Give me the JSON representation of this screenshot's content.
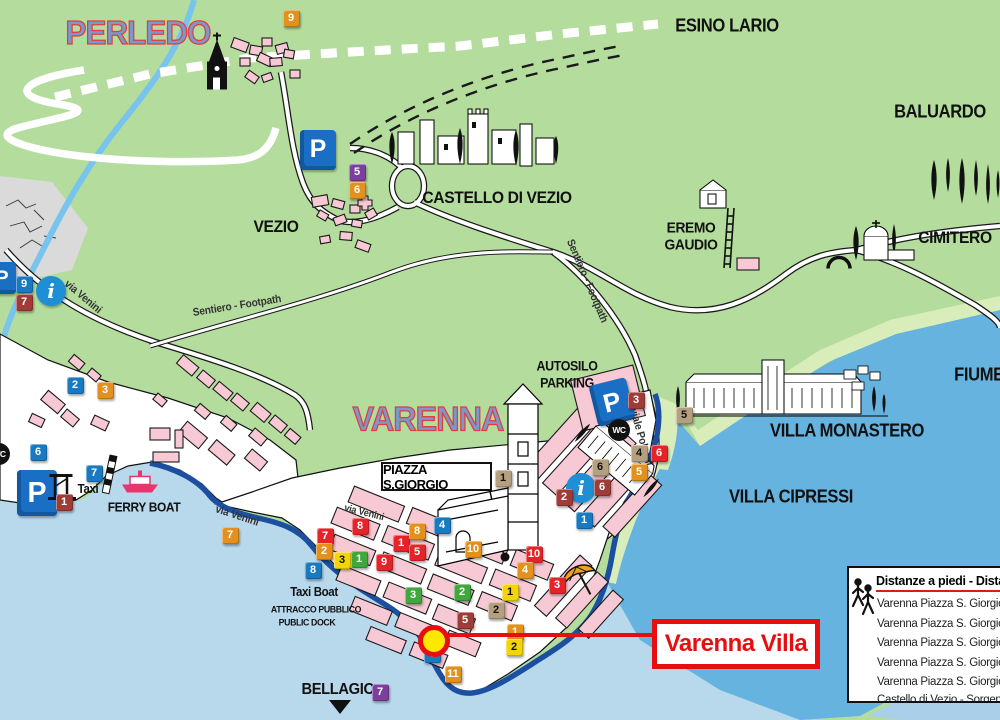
{
  "colors": {
    "land": "#b4dd9d",
    "land_light": "#d9edbb",
    "water_pale": "#b8d8ec",
    "water_deep": "#66b3e0",
    "water_corner": "#a9cfe9",
    "river": "#78c4ec",
    "building": "#f7c9d4",
    "promenade": "#1c4fa0",
    "title_fill": "#7b97cb",
    "title_stroke": "#e23d3d",
    "callout_red": "#e60f0f",
    "marker_blue": "#187ac1",
    "marker_red": "#e62329",
    "marker_orange": "#e3901d",
    "marker_yellow": "#f3d406",
    "marker_green": "#3fa73c",
    "marker_maroon": "#a03c38",
    "marker_tan": "#b49f7e",
    "marker_purple": "#7d3f9d"
  },
  "titles": [
    {
      "text": "PERLEDO",
      "x": 138,
      "y": 33,
      "size": 33
    },
    {
      "text": "VARENNA",
      "x": 428,
      "y": 420,
      "size": 34
    }
  ],
  "labels": [
    {
      "text": "ESINO LARIO",
      "x": 727,
      "y": 26,
      "size": 18
    },
    {
      "text": "BALUARDO",
      "x": 940,
      "y": 112,
      "size": 18
    },
    {
      "text": "CASTELLO DI VEZIO",
      "x": 497,
      "y": 198,
      "size": 17
    },
    {
      "text": "VEZIO",
      "x": 276,
      "y": 227,
      "size": 17
    },
    {
      "text": "EREMO",
      "x": 691,
      "y": 228,
      "size": 15
    },
    {
      "text": "GAUDIO",
      "x": 691,
      "y": 245,
      "size": 15
    },
    {
      "text": "CIMITERO",
      "x": 955,
      "y": 238,
      "size": 17
    },
    {
      "text": "AUTOSILO",
      "x": 567,
      "y": 366,
      "size": 13.5
    },
    {
      "text": "PARKING",
      "x": 567,
      "y": 383,
      "size": 13.5
    },
    {
      "text": "VILLA MONASTERO",
      "x": 847,
      "y": 431,
      "size": 18
    },
    {
      "text": "VILLA CIPRESSI",
      "x": 791,
      "y": 497,
      "size": 18
    },
    {
      "text": "FIUME",
      "x": 979,
      "y": 375,
      "size": 18
    },
    {
      "text": "Taxi",
      "x": 88,
      "y": 489,
      "size": 12.5
    },
    {
      "text": "FERRY BOAT",
      "x": 144,
      "y": 507,
      "size": 13
    },
    {
      "text": "Taxi Boat",
      "x": 314,
      "y": 592,
      "size": 12.5
    },
    {
      "text": "ATTRACCO PUBBLICO",
      "x": 316,
      "y": 610,
      "size": 9.5
    },
    {
      "text": "PUBLIC DOCK",
      "x": 307,
      "y": 623,
      "size": 9.5
    },
    {
      "text": "BELLAGIO",
      "x": 338,
      "y": 690,
      "size": 16
    },
    {
      "text": "via Venini",
      "x": 83,
      "y": 297,
      "size": 11,
      "rot": 40,
      "cls": "street"
    },
    {
      "text": "Sentiero - Footpath",
      "x": 237,
      "y": 306,
      "size": 11,
      "rot": -9,
      "cls": "street"
    },
    {
      "text": "Sentiero - Footpath",
      "x": 587,
      "y": 281,
      "size": 11,
      "rot": 67,
      "cls": "street"
    },
    {
      "text": "via Venini",
      "x": 237,
      "y": 516,
      "size": 11,
      "rot": 18,
      "cls": "street"
    },
    {
      "text": "via Venini",
      "x": 364,
      "y": 513,
      "size": 10,
      "rot": 14,
      "cls": "street"
    },
    {
      "text": "viale Polvani",
      "x": 641,
      "y": 437,
      "size": 11,
      "rot": 74,
      "cls": "street"
    }
  ],
  "piazza": {
    "text": "PIAZZA S.GIORGIO"
  },
  "callout": {
    "text": "Varenna Villa"
  },
  "legend": {
    "title": "Distanze a piedi - Dista",
    "rows": [
      "Varenna Piazza S. Giorgio",
      "Varenna Piazza S. Giorgio",
      "Varenna Piazza S. Giorgio",
      "Varenna Piazza S. Giorgio",
      "Varenna Piazza S. Giorgio",
      "Castello di Vezio - Sorgen"
    ]
  },
  "markers": [
    {
      "n": "9",
      "c": "orange",
      "x": 291,
      "y": 18
    },
    {
      "n": "5",
      "c": "purple",
      "x": 357,
      "y": 172
    },
    {
      "n": "6",
      "c": "orange",
      "x": 357,
      "y": 190
    },
    {
      "n": "9",
      "c": "blue",
      "x": 24,
      "y": 284
    },
    {
      "n": "7",
      "c": "maroon",
      "x": 24,
      "y": 302
    },
    {
      "n": "2",
      "c": "blue",
      "x": 75,
      "y": 385
    },
    {
      "n": "3",
      "c": "orange",
      "x": 105,
      "y": 390
    },
    {
      "n": "6",
      "c": "blue",
      "x": 38,
      "y": 452
    },
    {
      "n": "7",
      "c": "blue",
      "x": 94,
      "y": 473
    },
    {
      "n": "1",
      "c": "maroon",
      "x": 64,
      "y": 502
    },
    {
      "n": "7",
      "c": "orange",
      "x": 230,
      "y": 535
    },
    {
      "n": "7",
      "c": "red",
      "x": 325,
      "y": 536
    },
    {
      "n": "8",
      "c": "red",
      "x": 360,
      "y": 526
    },
    {
      "n": "2",
      "c": "orange",
      "x": 324,
      "y": 551
    },
    {
      "n": "3",
      "c": "yellow",
      "x": 342,
      "y": 560
    },
    {
      "n": "1",
      "c": "green",
      "x": 359,
      "y": 559
    },
    {
      "n": "8",
      "c": "blue",
      "x": 313,
      "y": 570
    },
    {
      "n": "9",
      "c": "red",
      "x": 384,
      "y": 562
    },
    {
      "n": "1",
      "c": "red",
      "x": 401,
      "y": 543
    },
    {
      "n": "5",
      "c": "red",
      "x": 417,
      "y": 552
    },
    {
      "n": "8",
      "c": "orange",
      "x": 417,
      "y": 531
    },
    {
      "n": "4",
      "c": "blue",
      "x": 442,
      "y": 525
    },
    {
      "n": "10",
      "c": "orange",
      "x": 473,
      "y": 549
    },
    {
      "n": "10",
      "c": "red",
      "x": 534,
      "y": 554
    },
    {
      "n": "4",
      "c": "orange",
      "x": 525,
      "y": 570
    },
    {
      "n": "1",
      "c": "blue",
      "x": 584,
      "y": 520
    },
    {
      "n": "3",
      "c": "red",
      "x": 557,
      "y": 585
    },
    {
      "n": "3",
      "c": "green",
      "x": 413,
      "y": 595
    },
    {
      "n": "2",
      "c": "green",
      "x": 462,
      "y": 592
    },
    {
      "n": "1",
      "c": "yellow",
      "x": 510,
      "y": 592
    },
    {
      "n": "2",
      "c": "tan",
      "x": 496,
      "y": 610
    },
    {
      "n": "5",
      "c": "maroon",
      "x": 465,
      "y": 620
    },
    {
      "n": "1",
      "c": "orange",
      "x": 515,
      "y": 632
    },
    {
      "n": "2",
      "c": "yellow",
      "x": 514,
      "y": 647
    },
    {
      "n": "3",
      "c": "blue",
      "x": 432,
      "y": 654
    },
    {
      "n": "11",
      "c": "orange",
      "x": 453,
      "y": 674
    },
    {
      "n": "7",
      "c": "purple",
      "x": 380,
      "y": 692
    },
    {
      "n": "1",
      "c": "tan",
      "x": 503,
      "y": 478
    },
    {
      "n": "2",
      "c": "maroon",
      "x": 564,
      "y": 497
    },
    {
      "n": "6",
      "c": "maroon",
      "x": 602,
      "y": 487
    },
    {
      "n": "6",
      "c": "tan",
      "x": 600,
      "y": 467
    },
    {
      "n": "3",
      "c": "maroon",
      "x": 636,
      "y": 400
    },
    {
      "n": "5",
      "c": "tan",
      "x": 684,
      "y": 415
    },
    {
      "n": "4",
      "c": "tan",
      "x": 639,
      "y": 453
    },
    {
      "n": "6",
      "c": "red",
      "x": 659,
      "y": 453
    },
    {
      "n": "5",
      "c": "orange",
      "x": 639,
      "y": 472
    }
  ],
  "icons": [
    {
      "t": "parking",
      "x": 300,
      "y": 130,
      "w": 36,
      "h": 40
    },
    {
      "t": "parking",
      "x": 17,
      "y": 470,
      "w": 40,
      "h": 46
    },
    {
      "t": "parking",
      "x": 593,
      "y": 381,
      "w": 38,
      "h": 42,
      "rot": -14
    },
    {
      "t": "parking",
      "x": -12,
      "y": 262,
      "w": 28,
      "h": 32
    },
    {
      "t": "wc",
      "x": 619,
      "y": 430
    },
    {
      "t": "wc",
      "x": -1,
      "y": 454
    },
    {
      "t": "info",
      "x": 51,
      "y": 291
    },
    {
      "t": "info",
      "x": 581,
      "y": 488
    },
    {
      "t": "ferry",
      "x": 140,
      "y": 485
    },
    {
      "t": "pier",
      "x": 62,
      "y": 489
    },
    {
      "t": "pole",
      "x": 110,
      "y": 477
    },
    {
      "t": "umbrella",
      "x": 580,
      "y": 584
    },
    {
      "t": "church",
      "x": 217,
      "y": 64
    },
    {
      "t": "dot",
      "x": 505,
      "y": 558
    },
    {
      "t": "arch",
      "x": 839,
      "y": 264
    }
  ]
}
